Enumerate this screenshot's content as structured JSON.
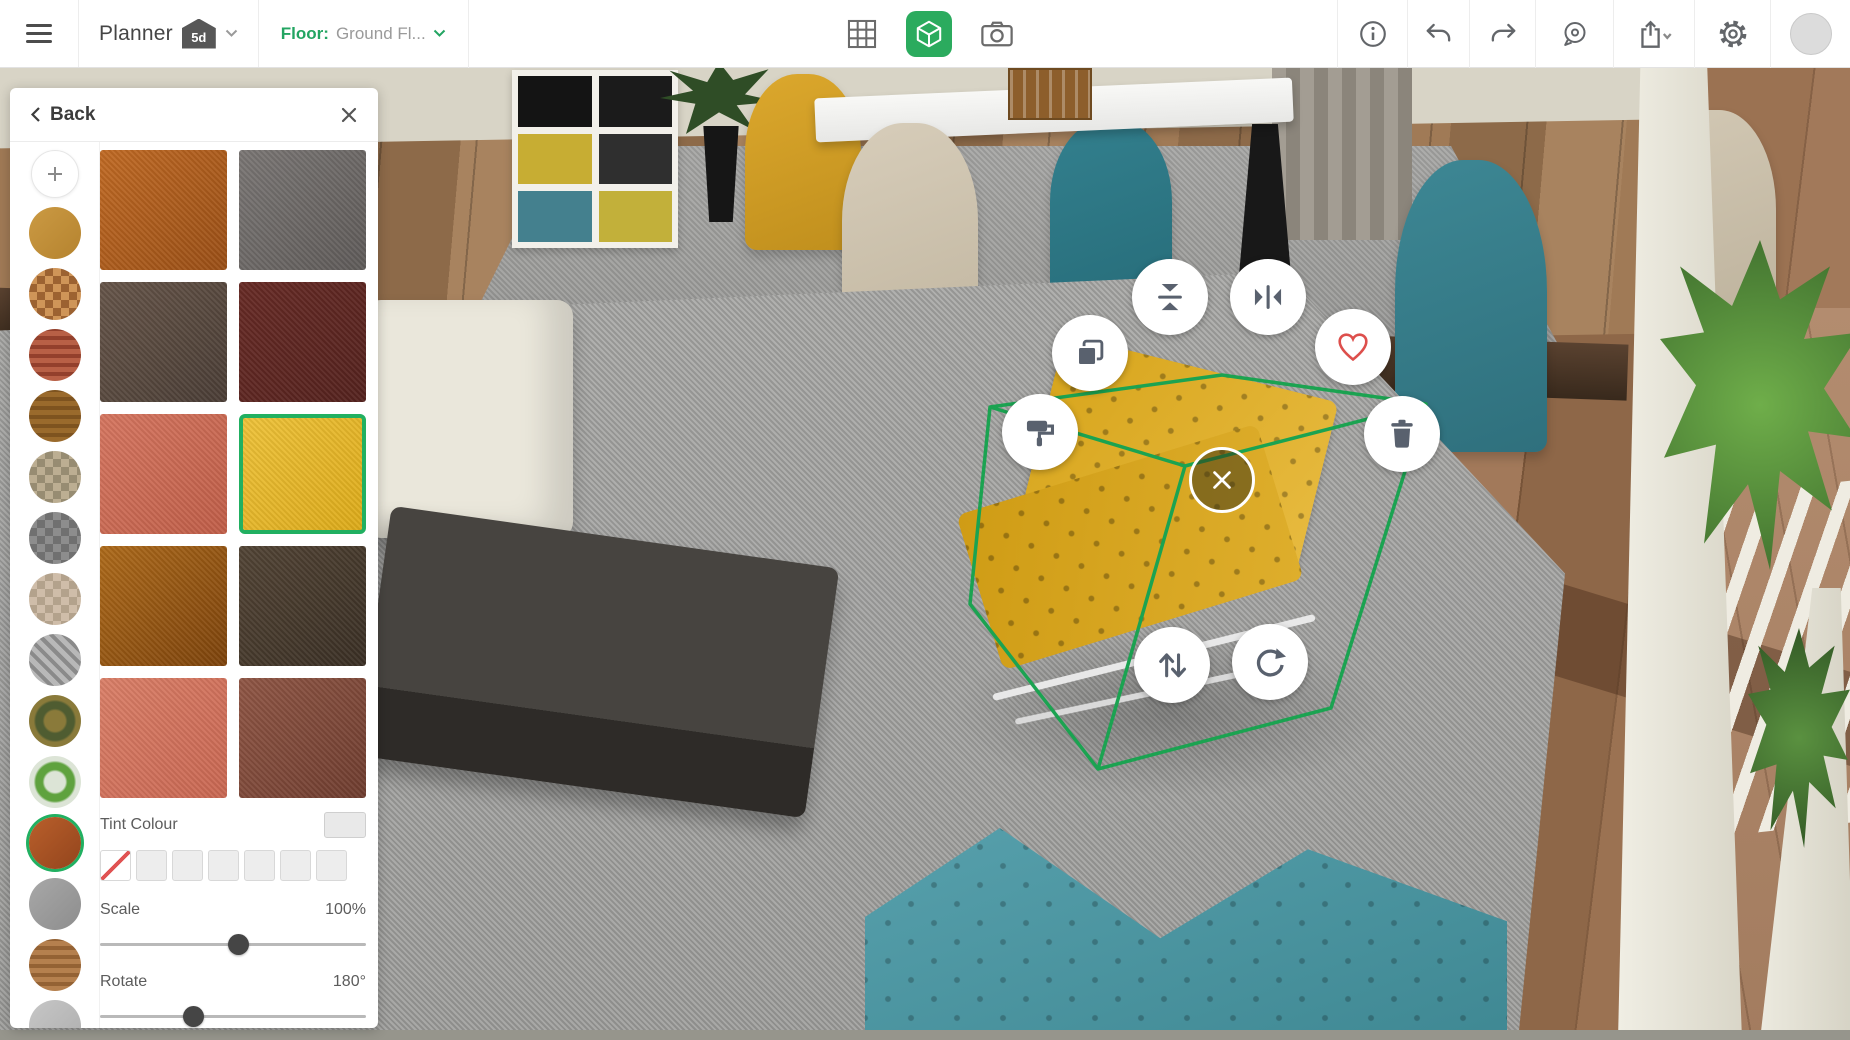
{
  "app": {
    "name": "Planner",
    "badge": "5d"
  },
  "topbar": {
    "floor_label": "Floor:",
    "floor_value": "Ground Fl...",
    "icons_center": [
      "2d-grid-view",
      "3d-view",
      "snapshot"
    ],
    "active_view": "3d-view",
    "icons_right": [
      "info",
      "undo",
      "redo",
      "measure",
      "share",
      "settings",
      "account"
    ],
    "accent_green": "#2bab5e"
  },
  "panel": {
    "back_label": "Back",
    "swatch_rail": [
      {
        "name": "add-texture",
        "type": "button"
      },
      {
        "name": "cork",
        "pattern": "flat",
        "colors": [
          "#cb9a43",
          "#b5832f"
        ]
      },
      {
        "name": "parquet-mosaic",
        "pattern": "checks",
        "colors": [
          "#cf9558",
          "#9c6231"
        ]
      },
      {
        "name": "red-brick",
        "pattern": "stripes",
        "colors": [
          "#b86046",
          "#93402c"
        ]
      },
      {
        "name": "wood-planks",
        "pattern": "stripes",
        "colors": [
          "#9a6a2c",
          "#7e531f"
        ]
      },
      {
        "name": "pebbles",
        "pattern": "checks",
        "colors": [
          "#bcae92",
          "#978c72"
        ]
      },
      {
        "name": "gray-carpet",
        "pattern": "checks",
        "colors": [
          "#8d8d8d",
          "#707070"
        ]
      },
      {
        "name": "beige-plaid",
        "pattern": "checks",
        "colors": [
          "#cfbda9",
          "#b3a28c"
        ]
      },
      {
        "name": "gray-marble",
        "pattern": "diag",
        "colors": [
          "#b8b8b8",
          "#8a8a8a"
        ]
      },
      {
        "name": "mosaic-medallion",
        "pattern": "radial",
        "colors": [
          "#8a7a3a",
          "#4f5c31"
        ]
      },
      {
        "name": "green-moss",
        "pattern": "radial",
        "colors": [
          "#dce4d6",
          "#5fa23e"
        ]
      },
      {
        "name": "terracotta-leather",
        "pattern": "flat",
        "colors": [
          "#b95f2b",
          "#93451d"
        ],
        "selected": true
      },
      {
        "name": "gray-stone",
        "pattern": "flat",
        "colors": [
          "#a8a8a8",
          "#8d8d8d"
        ]
      },
      {
        "name": "copper-wood",
        "pattern": "stripes",
        "colors": [
          "#b5804e",
          "#946234"
        ]
      },
      {
        "name": "light-granite",
        "pattern": "flat",
        "colors": [
          "#c6c6c6",
          "#aeaeae"
        ]
      }
    ],
    "texture_tiles": [
      {
        "name": "orange-leather",
        "colors": [
          "#c06a24",
          "#9a4f16"
        ]
      },
      {
        "name": "gray-leather",
        "colors": [
          "#7a7674",
          "#5f5b59"
        ]
      },
      {
        "name": "brown-leather",
        "colors": [
          "#665549",
          "#4a3d35"
        ]
      },
      {
        "name": "burgundy-leather",
        "colors": [
          "#672a25",
          "#54221e"
        ]
      },
      {
        "name": "coral-leather",
        "colors": [
          "#d57660",
          "#c05e48"
        ]
      },
      {
        "name": "yellow-leather",
        "colors": [
          "#eec23a",
          "#ddab1a"
        ],
        "selected": true
      },
      {
        "name": "amber-leather",
        "colors": [
          "#ad6a1a",
          "#7d430c"
        ]
      },
      {
        "name": "dark-brown-leather",
        "colors": [
          "#524435",
          "#3a2f24"
        ]
      },
      {
        "name": "salmon-leather",
        "colors": [
          "#da7f68",
          "#c96752"
        ]
      },
      {
        "name": "russet-leather",
        "colors": [
          "#8f5645",
          "#6f3d2f"
        ]
      }
    ],
    "tint": {
      "label": "Tint Colour",
      "current_swatch_color": "#e9e9e9",
      "none_slash_color": "#e05252",
      "palette": [
        "none",
        "empty",
        "empty",
        "empty",
        "empty",
        "empty",
        "empty"
      ]
    },
    "scale": {
      "label": "Scale",
      "value": "100%",
      "percent": 52
    },
    "rotate": {
      "label": "Rotate",
      "value": "180°",
      "percent": 35
    },
    "selected_tile_border": "#21b061"
  },
  "selection_menu": {
    "actions": [
      "copy",
      "flip-vertical",
      "flip-horizontal",
      "favorite",
      "paint",
      "delete",
      "close",
      "move-vertical",
      "rotate"
    ],
    "icon_color": "#59616e",
    "heart_color": "#dd4f4c"
  },
  "scene": {
    "selection_color": "#1ba351"
  }
}
